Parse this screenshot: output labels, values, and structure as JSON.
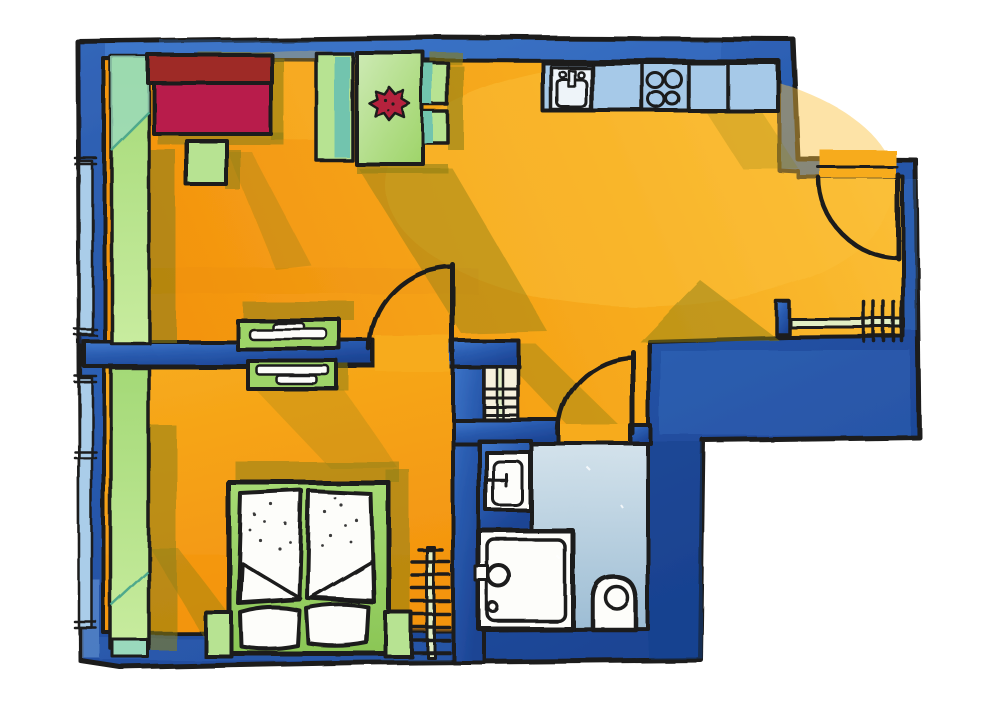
{
  "meta": {
    "type": "watercolor-floor-plan-illustration",
    "style": "hand-drawn ink and watercolor apartment floor plan",
    "background": "white"
  },
  "palette": {
    "outline": "#1a1a1a",
    "wall_light": "#4079cc",
    "wall_mid": "#2a5cb0",
    "wall_dark": "#1c4494",
    "wall_shade_dark": "#16408c",
    "wall_shade_light": "#6f9fdc",
    "counter_blue": "#a6c9e8",
    "floor_main": "#f7ab1c",
    "floor_deep": "#f3940f",
    "floor_bright": "#fbc23b",
    "floor_streak": "#e8860b",
    "shadow_olive": "#8d7f14",
    "green_light": "#b7e392",
    "green_mid": "#9ed468",
    "green_pale": "#cdeab4",
    "teal": "#72c4ae",
    "teal_dark": "#4fa98c",
    "curtain_1": "#a4d977",
    "curtain_2": "#c8ec9f",
    "curtain_teal": "#9ad9bd",
    "bed_green_1": "#a6da74",
    "bed_green_2": "#8bc656",
    "sofa_back": "#9e2b28",
    "sofa_seat": "#b81e4b",
    "flower_red": "#b5233c",
    "bath_light": "#d3e2eb",
    "bath_deep": "#9dbdd4",
    "window_blue": "#aacde9",
    "niche_pale": "#f6f1dd",
    "radiator_green": "#e2efc4",
    "fixture_white": "#fdfdfa"
  },
  "floorplan": {
    "rooms": [
      {
        "name": "living-dining-kitchen",
        "floor_color": "orange",
        "furniture": [
          "sofa",
          "side-table",
          "dining-table-with-flower",
          "dining-bench",
          "two-dining-chairs",
          "sideboard",
          "kitchen-counter",
          "kitchen-sink",
          "stove-4-burners",
          "window-curtain"
        ]
      },
      {
        "name": "bedroom",
        "floor_color": "orange",
        "furniture": [
          "double-bed",
          "two-duvets",
          "two-pillows",
          "sideboard",
          "radiator",
          "window-curtain"
        ]
      },
      {
        "name": "bathroom",
        "floor_color": "light-blue",
        "furniture": [
          "wash-basin",
          "shower",
          "toilet"
        ]
      },
      {
        "name": "hallway",
        "floor_color": "orange",
        "furniture": [
          "radiator-niche"
        ]
      },
      {
        "name": "entry-corridor",
        "floor_color": "orange",
        "furniture": [
          "radiator"
        ]
      }
    ],
    "doors": [
      "entrance-door",
      "bedroom-door",
      "bathroom-door"
    ],
    "windows": [
      "left-wall-window-upper",
      "left-wall-window-lower"
    ]
  }
}
